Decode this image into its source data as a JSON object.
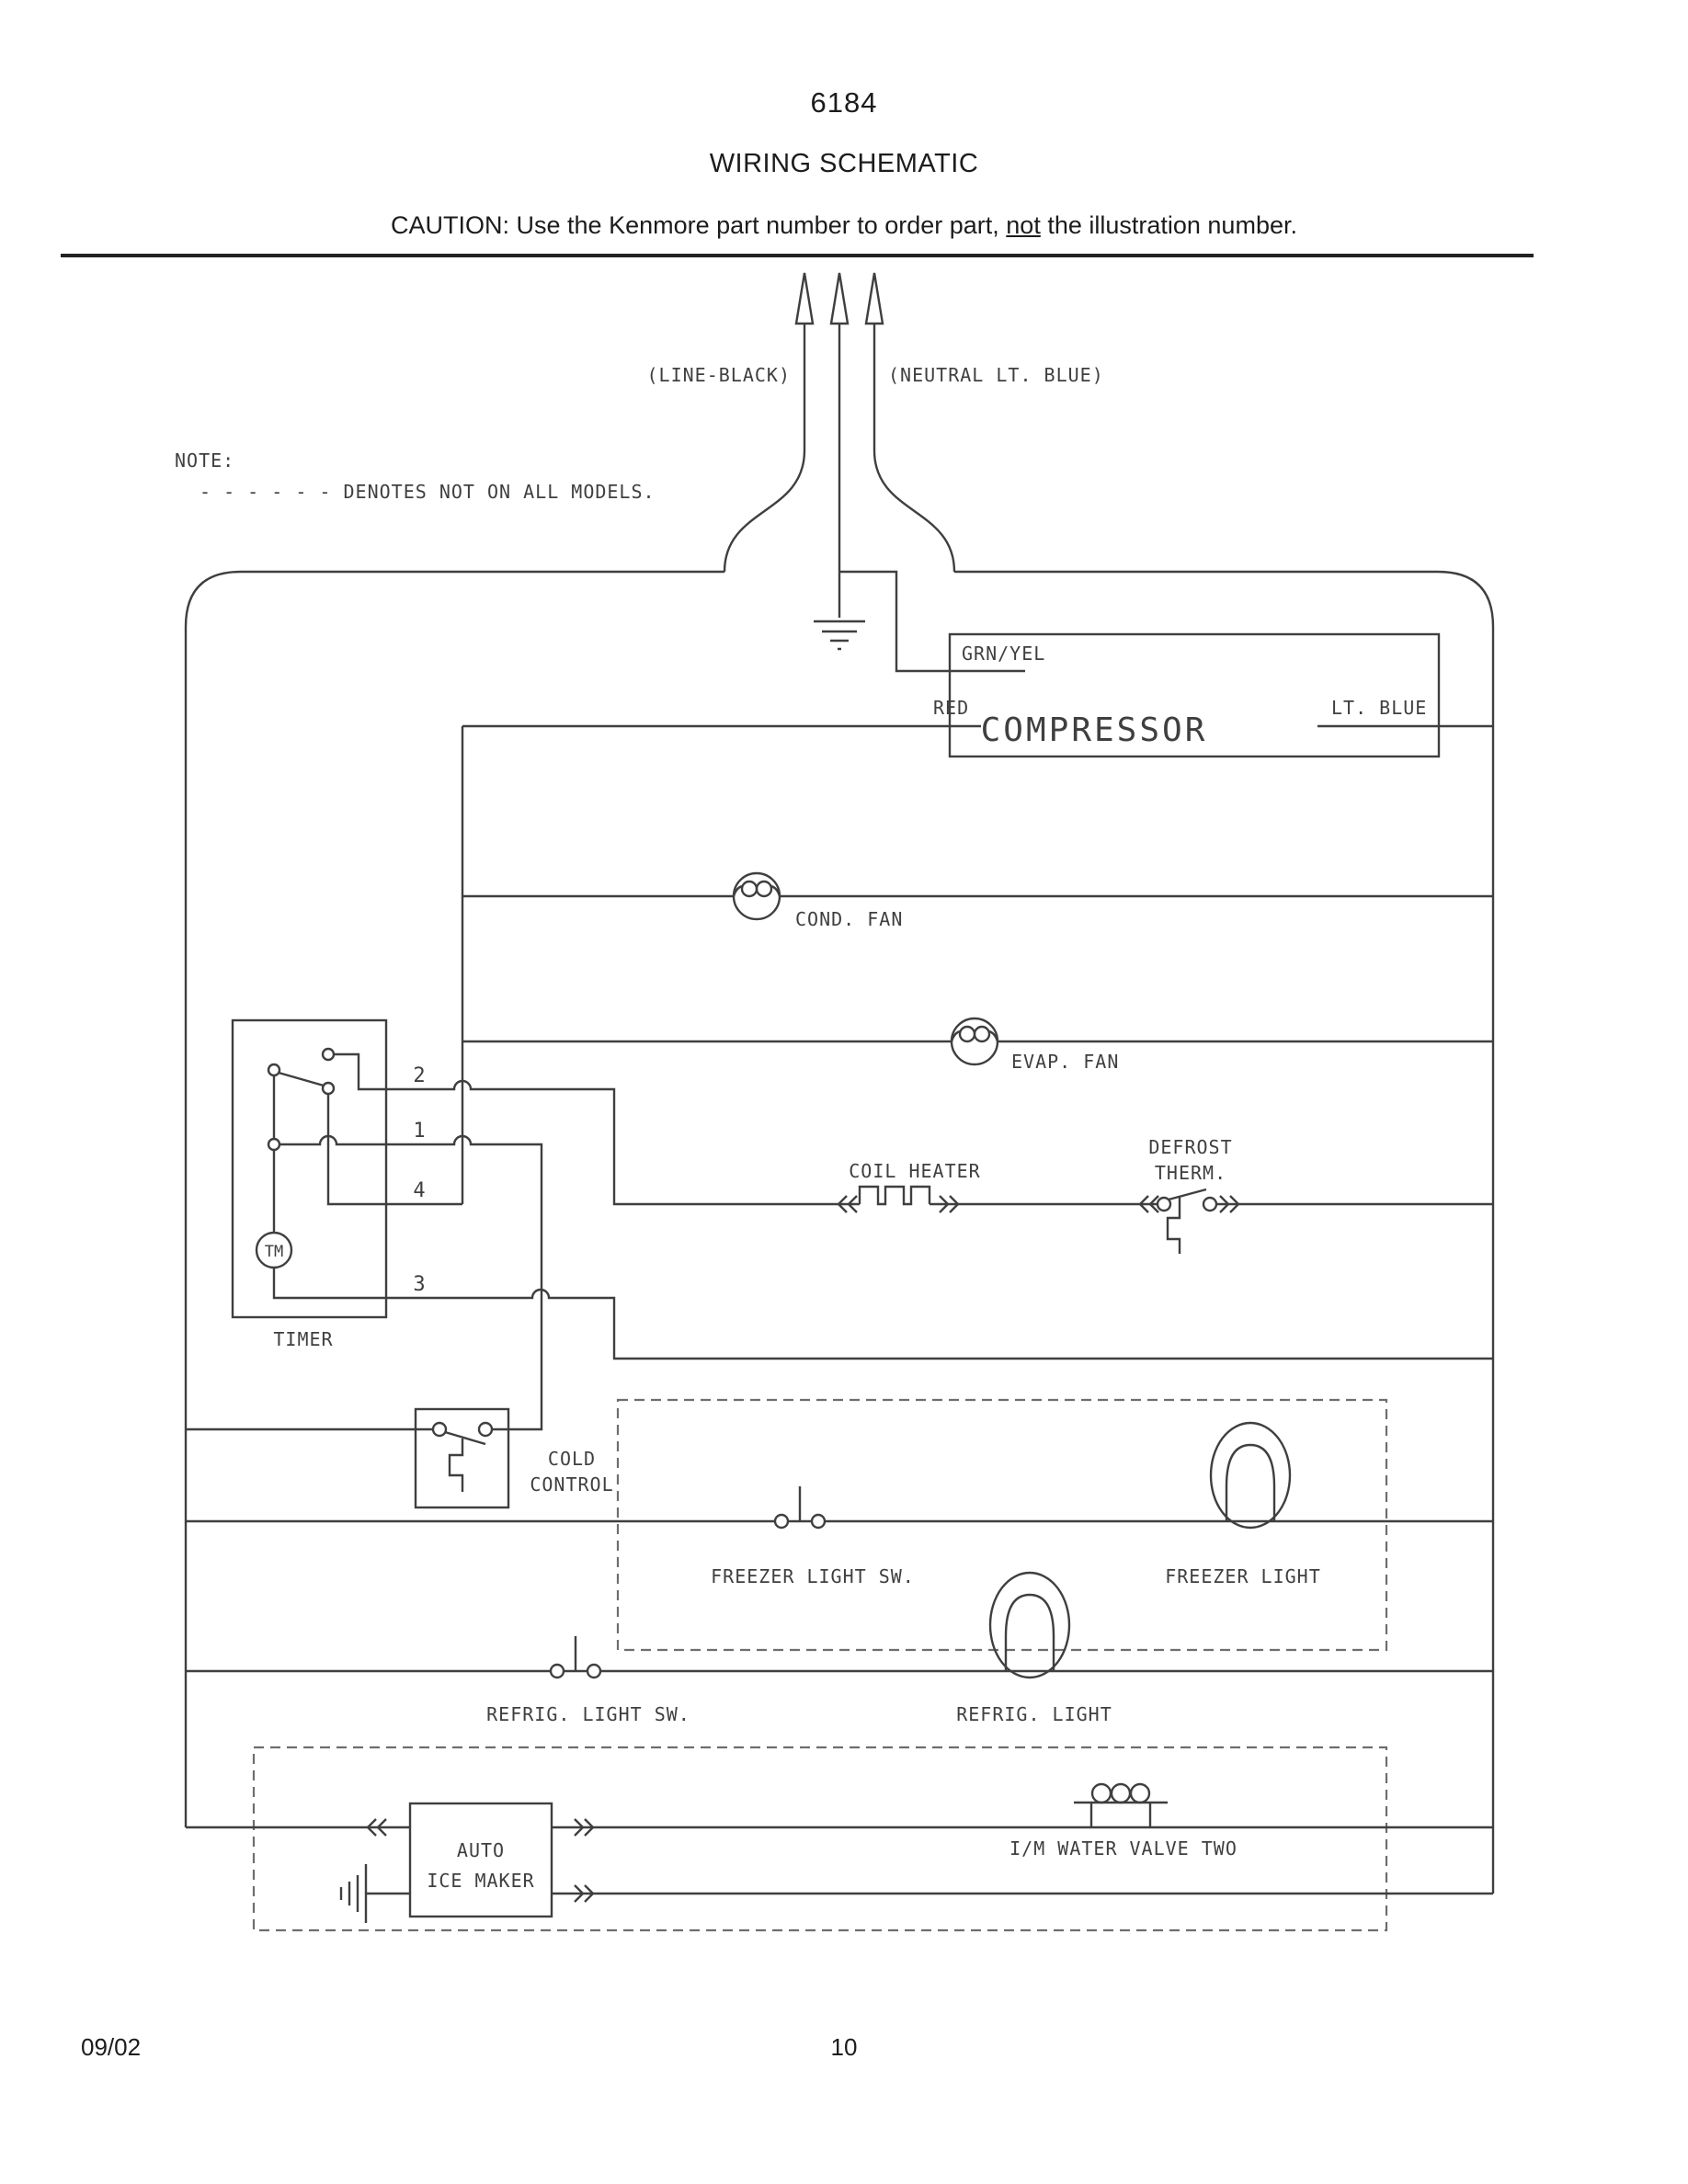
{
  "header": {
    "part_number": "6184",
    "title": "WIRING SCHEMATIC",
    "caution": {
      "prefix": "CAUTION: Use the Kenmore part number to order part, ",
      "emphasis": "not",
      "suffix": " the illustration number."
    }
  },
  "note": {
    "label": "NOTE:",
    "legend": "- - - - - - DENOTES NOT ON ALL MODELS."
  },
  "supply": {
    "line_label": "(LINE-BLACK)",
    "neutral_label": "(NEUTRAL LT. BLUE)"
  },
  "compressor": {
    "name": "COMPRESSOR",
    "terminal_grn_yel": "GRN/YEL",
    "terminal_red": "RED",
    "terminal_lt_blue": "LT. BLUE"
  },
  "fans": {
    "cond": "COND. FAN",
    "evap": "EVAP. FAN"
  },
  "timer": {
    "name": "TIMER",
    "motor": "TM",
    "terminal_2": "2",
    "terminal_1": "1",
    "terminal_4": "4",
    "terminal_3": "3"
  },
  "defrost": {
    "coil_heater": "COIL HEATER",
    "therm_line1": "DEFROST",
    "therm_line2": "THERM."
  },
  "cold_control": {
    "line1": "COLD",
    "line2": "CONTROL"
  },
  "lights": {
    "freezer_switch": "FREEZER LIGHT SW.",
    "freezer_light": "FREEZER LIGHT",
    "refrig_switch": "REFRIG. LIGHT SW.",
    "refrig_light": "REFRIG. LIGHT"
  },
  "ice_maker": {
    "line1": "AUTO",
    "line2": "ICE MAKER",
    "water_valve": "I/M WATER VALVE TWO"
  },
  "footer": {
    "date": "09/02",
    "page": "10"
  },
  "colors": {
    "line": "#3f3f3f",
    "dashed": "#6e6e6e",
    "background": "#ffffff"
  }
}
